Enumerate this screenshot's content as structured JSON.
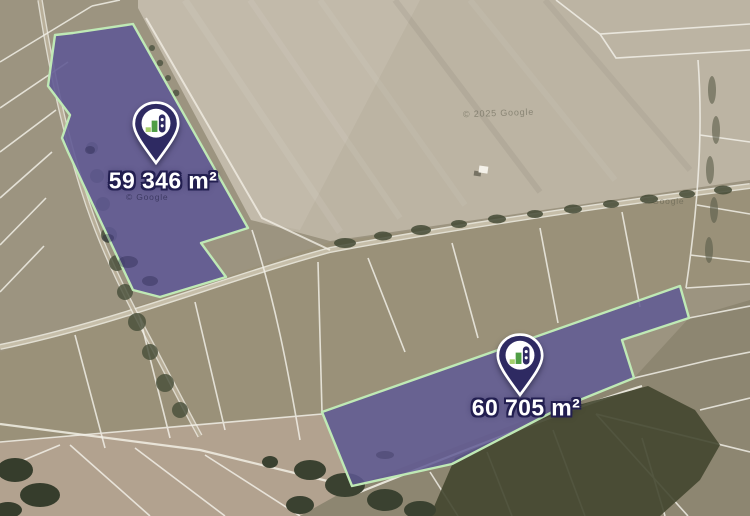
{
  "parcels": [
    {
      "id": "parcel-1",
      "area_label": "59 346 m²"
    },
    {
      "id": "parcel-2",
      "area_label": "60 705 m²"
    }
  ],
  "watermarks": [
    {
      "text": "© 2025 Google"
    },
    {
      "text": "© Google"
    },
    {
      "text": "© Google"
    }
  ],
  "icons": {
    "pin_logo": "bar-chart-field-logo"
  },
  "colors": {
    "parcel_fill": "#5e5894",
    "parcel_border": "#bfe9b5",
    "pin_fill": "#2e2a62",
    "pin_icon_green": "#4f9e45",
    "pin_icon_light_green": "#a5cf6b",
    "label_text": "#ffffff",
    "label_outline": "#221e50"
  }
}
